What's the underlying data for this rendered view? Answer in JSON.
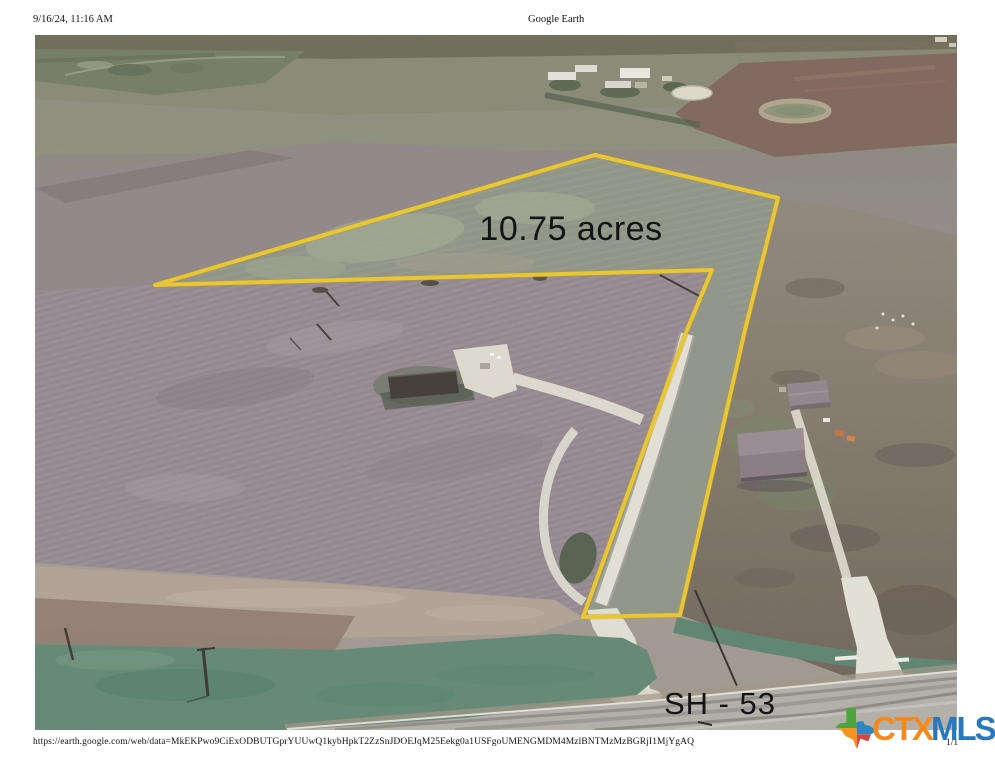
{
  "header": {
    "datetime": "9/16/24, 11:16 AM",
    "title": "Google Earth"
  },
  "map": {
    "acreage_label": "10.75 acres",
    "road_label": "SH - 53",
    "parcel_outline_color": "#e9c634",
    "label_color": "#141414"
  },
  "footer": {
    "url": "https://earth.google.com/web/data=MkEKPwo9CiExODBUTGprYUUwQ1kybHpkT2ZzSnJDOEJqM25Eekg0a1USFgoUMENGMDM4MzlBNTMzMzBGRjI1MjYgAQ",
    "page_number": "1/1"
  },
  "logo": {
    "ctx_text": "CTX",
    "mls_text": "MLS",
    "ctx_color": "#f5891d",
    "mls_color": "#2878c0",
    "texas_icon_colors": {
      "green": "#4ea43f",
      "orange": "#f6921e",
      "blue": "#2e86c1",
      "red": "#d64541"
    }
  }
}
